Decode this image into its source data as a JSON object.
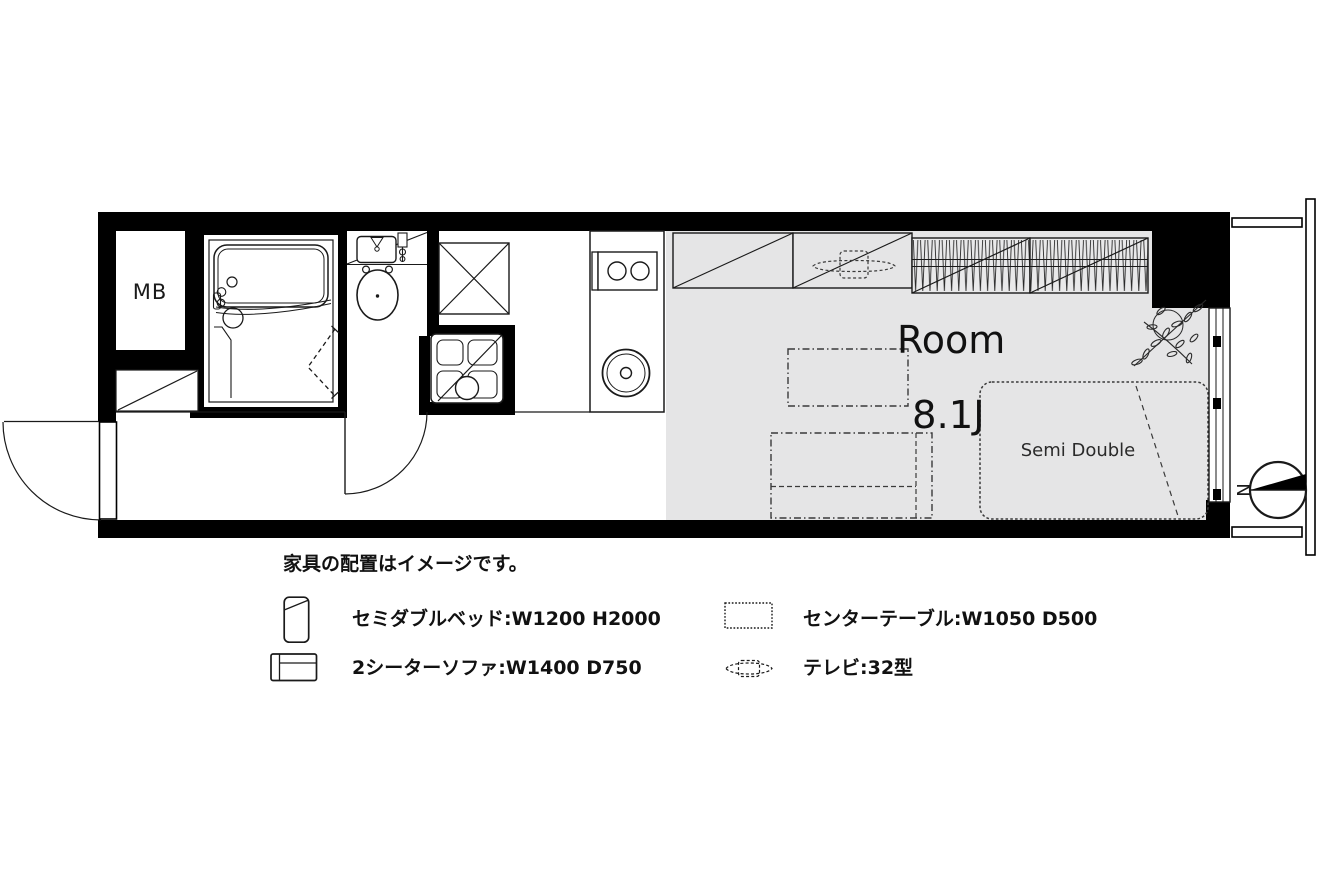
{
  "floor_plan": {
    "mb_label": "MB",
    "room_label": "Room",
    "room_size_label": "8.1J",
    "bed_label": "Semi Double",
    "compass_label": "N",
    "colors": {
      "wall": "#000000",
      "floor_gray": "#e5e5e6",
      "line": "#1a1a1a",
      "furniture_dash": "#3a3a3a",
      "background": "#ffffff"
    },
    "icons": {
      "north-arrow-icon": "compass circle with black wedge pointing right",
      "entrance-door-icon": "quarter-circle swing door on left wall",
      "toilet-door-icon": "quarter-circle swing door to hallway",
      "folding-door-icon": "dashed V fold door of bathroom",
      "bathtub-icon": "unit bath with tub",
      "toilet-icon": "toilet bowl with vanity",
      "washing-machine-space-icon": "square with X",
      "laundry-pan-icon": "pan with drain circle",
      "stove-icon": "two-burner stove",
      "sink-icon": "round kitchen sink",
      "storage-icon": "rectangle with diagonal",
      "closet-hanger-icon": "hatched closet with hanger pipe",
      "tv-icon": "dashed flat tv",
      "table-icon": "dashed rectangle",
      "sofa-icon": "dashed sofa with backrest",
      "bed-icon": "dotted rounded bed",
      "plant-icon": "leafy plant sprig",
      "window-icon": "sliding window panes",
      "balcony-icon": "balcony rails"
    }
  },
  "legend": {
    "disclaimer": "家具の配置はイメージです。",
    "items": [
      {
        "id": "semi-double-bed",
        "label": "セミダブルベッド:W1200 H2000"
      },
      {
        "id": "center-table",
        "label": "センターテーブル:W1050 D500"
      },
      {
        "id": "two-seater-sofa",
        "label": "2シーターソファ:W1400 D750"
      },
      {
        "id": "tv-32",
        "label": "テレビ:32型"
      }
    ]
  }
}
